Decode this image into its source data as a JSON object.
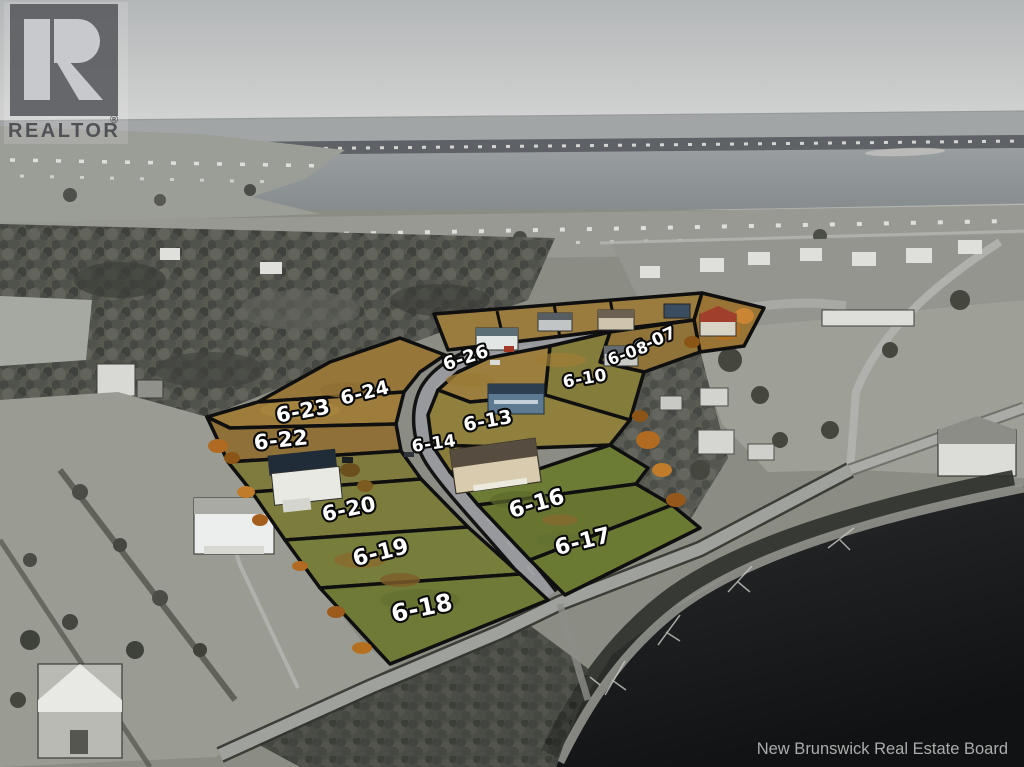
{
  "branding": {
    "logo_text": "REALTOR",
    "registered_mark": "®"
  },
  "watermark": {
    "text": "New Brunswick Real Estate Board"
  },
  "lot_labels": [
    {
      "label": "6-07",
      "x": 655,
      "y": 341,
      "rot": -24,
      "size": 17
    },
    {
      "label": "6-08",
      "x": 628,
      "y": 353,
      "rot": -20,
      "size": 16
    },
    {
      "label": "6-10",
      "x": 585,
      "y": 379,
      "rot": -10,
      "size": 17
    },
    {
      "label": "6-26",
      "x": 466,
      "y": 358,
      "rot": -18,
      "size": 18
    },
    {
      "label": "6-24",
      "x": 365,
      "y": 393,
      "rot": -14,
      "size": 19
    },
    {
      "label": "6-23",
      "x": 303,
      "y": 411,
      "rot": -10,
      "size": 21
    },
    {
      "label": "6-22",
      "x": 281,
      "y": 440,
      "rot": -6,
      "size": 21
    },
    {
      "label": "6-13",
      "x": 488,
      "y": 421,
      "rot": -10,
      "size": 19
    },
    {
      "label": "6-14",
      "x": 434,
      "y": 444,
      "rot": -8,
      "size": 17
    },
    {
      "label": "6-16",
      "x": 537,
      "y": 504,
      "rot": -16,
      "size": 22
    },
    {
      "label": "6-17",
      "x": 583,
      "y": 542,
      "rot": -14,
      "size": 22
    },
    {
      "label": "6-20",
      "x": 349,
      "y": 509,
      "rot": -12,
      "size": 21
    },
    {
      "label": "6-19",
      "x": 381,
      "y": 553,
      "rot": -14,
      "size": 22
    },
    {
      "label": "6-18",
      "x": 422,
      "y": 608,
      "rot": -12,
      "size": 24
    }
  ],
  "palette": {
    "sky_top": "#b4b7b8",
    "sky_bottom": "#d9dad8",
    "bay_water": "#8d9193",
    "dark_water": "#1a1c1e",
    "lot_outline": "#0f0f0f",
    "lot_grass_green": "#6b7a33",
    "lot_grass_tan": "#97763a",
    "autumn_orange": "#b06a22",
    "road_gray": "#9b9da0",
    "label_fill": "#ffffff",
    "label_outline": "#0a0a0a"
  }
}
